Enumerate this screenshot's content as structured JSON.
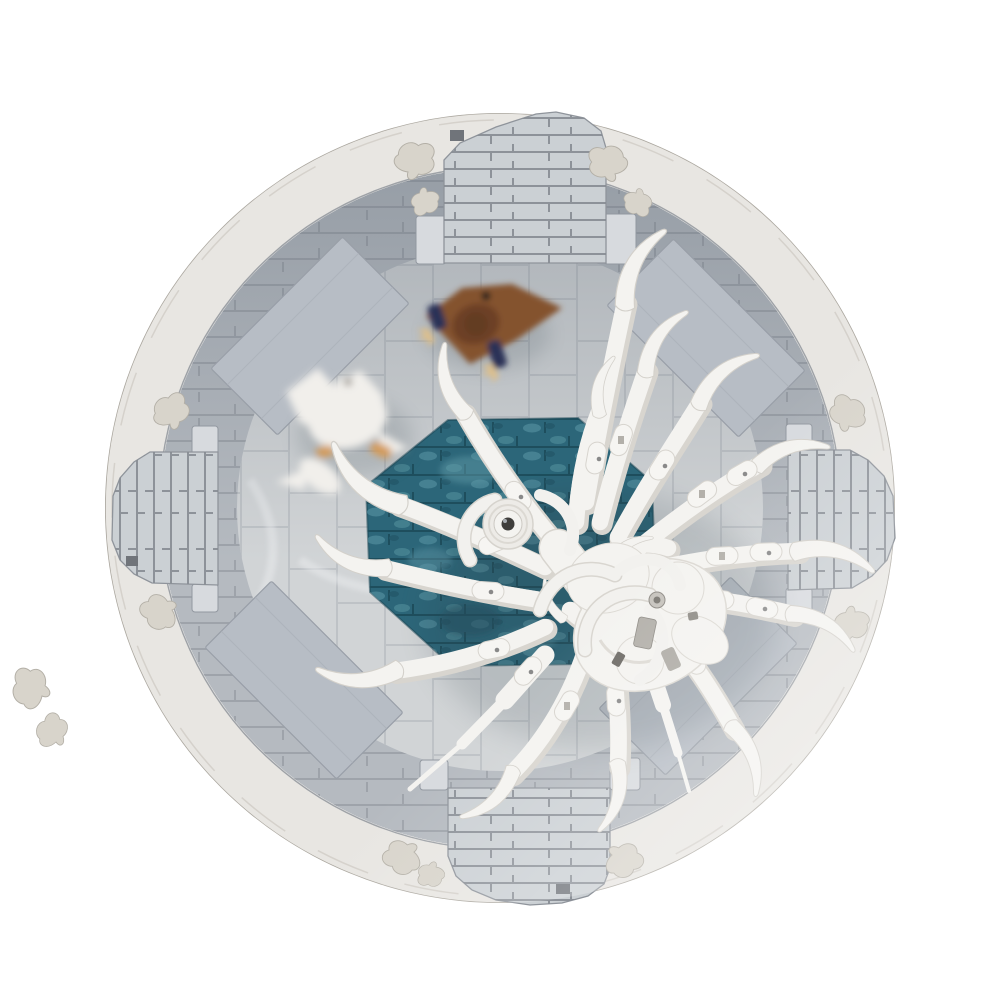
{
  "meta": {
    "domain": "product-render",
    "description": "Top-down 3D render of a LEGO-style MOC: circular stone arena with four gate towers, an octagonal teal water pool, a giant white skeletal spider boss with curved horn legs and one round eye, a white goose and a brown eagle figure on the arena floor",
    "background": "#ffffff"
  },
  "colors": {
    "outer_ring": "#e8e6e2",
    "outer_ring_edge": "#aaa69e",
    "wall": "#b5bac0",
    "wall_joint": "#9aa0a7",
    "floor": "#d1d4d6",
    "floor_joint": "#bcc0c4",
    "ramp": "#b7bdc5",
    "water": "#2c6679",
    "water_joint": "#1d4d5c",
    "water_light": "#569096",
    "gate": "#cbd0d4",
    "gate_joint": "#868b92",
    "gate_notch": "#70747a",
    "leaf": "#d8d4cb",
    "bone_white": "#f4f3f0",
    "bone_shadow": "#d8d5cf",
    "joint_gray": "#b3b0aa",
    "eye_pupil": "#3f3e3c",
    "goose_white": "#f1efeb",
    "goose_feet": "#d49a56",
    "goose_eye": "#6a6156",
    "eagle_wing": "#84522f",
    "eagle_body": "#6d4128",
    "eagle_arm": "#2c3157",
    "eagle_claw": "#dfc08a",
    "shadow": "#31424c"
  },
  "objects": {
    "arena": "circular stone arena",
    "north_gate": "north gate tower",
    "east_gate": "east gate tower",
    "south_gate": "south gate tower",
    "west_gate": "west gate tower",
    "water_pool": "octagonal teal water pool",
    "ramps": "four diagonal stone ramps",
    "spider": "white skeletal spider boss",
    "spider_eye": "single round eye",
    "goose": "white goose",
    "eagle": "brown eagle figure",
    "plants": "white leaf ornaments"
  }
}
